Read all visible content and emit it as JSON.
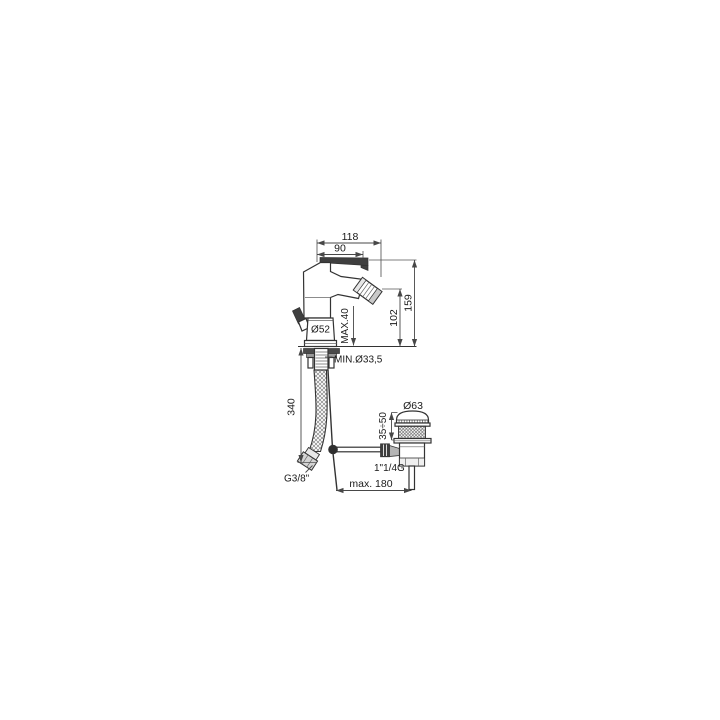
{
  "page": {
    "background": "#ffffff",
    "line_color": "#333333",
    "dim_color": "#474747"
  },
  "labels": {
    "dim_118": "118",
    "dim_90": "90",
    "dim_159": "159",
    "dim_102": "102",
    "dim_max_deck": "MAX.40",
    "dim_base_dia": "Ø52",
    "dim_min_hole": "MIN.Ø33,5",
    "dim_hose_drop": "340",
    "dim_cap_dia": "Ø63",
    "dim_adjust": "35÷50",
    "dim_waste_thread": "1\"1/4G",
    "dim_supply_thread": "G3/8\"",
    "dim_max_reach": "max. 180"
  }
}
